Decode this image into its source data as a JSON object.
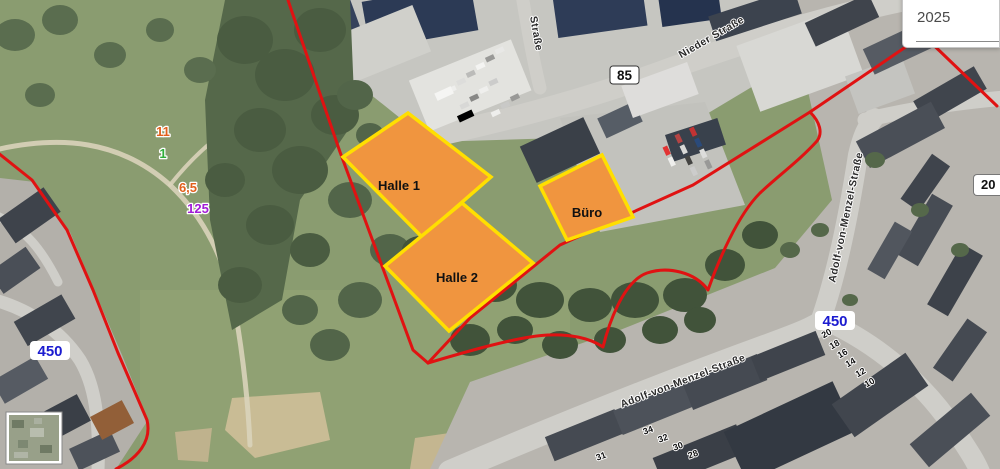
{
  "ui": {
    "year_selector": {
      "value": "2025"
    },
    "edge_badge": "20"
  },
  "map": {
    "building_labels": {
      "halle1": "Halle 1",
      "halle2": "Halle 2",
      "buero": "Büro"
    },
    "street_labels": {
      "nieder_strasse": "Nieder Straße",
      "strasse_partial": "Straße",
      "adolf_von_menzel": "Adolf-von-Menzel-Straße"
    },
    "route_badges": {
      "b85": "85",
      "l450": "450"
    },
    "parcel_labels": {
      "p11": "11",
      "p1": "1",
      "p65": "6,5",
      "p125": "125"
    },
    "house_numbers": {
      "h20": "20",
      "h18": "18",
      "h16": "16",
      "h14": "14",
      "h12": "12",
      "h10": "10",
      "h34": "34",
      "h32": "32",
      "h30": "30",
      "h28": "28",
      "h31": "31"
    },
    "colors": {
      "boundary_red": "#e01212",
      "building_fill": "#f0953f",
      "building_stroke": "#ffdf00",
      "route_450_blue": "#1b1bd0",
      "parcel_orange": "#e2601c",
      "parcel_green": "#2fae3a",
      "parcel_purple": "#a21bd6"
    }
  }
}
